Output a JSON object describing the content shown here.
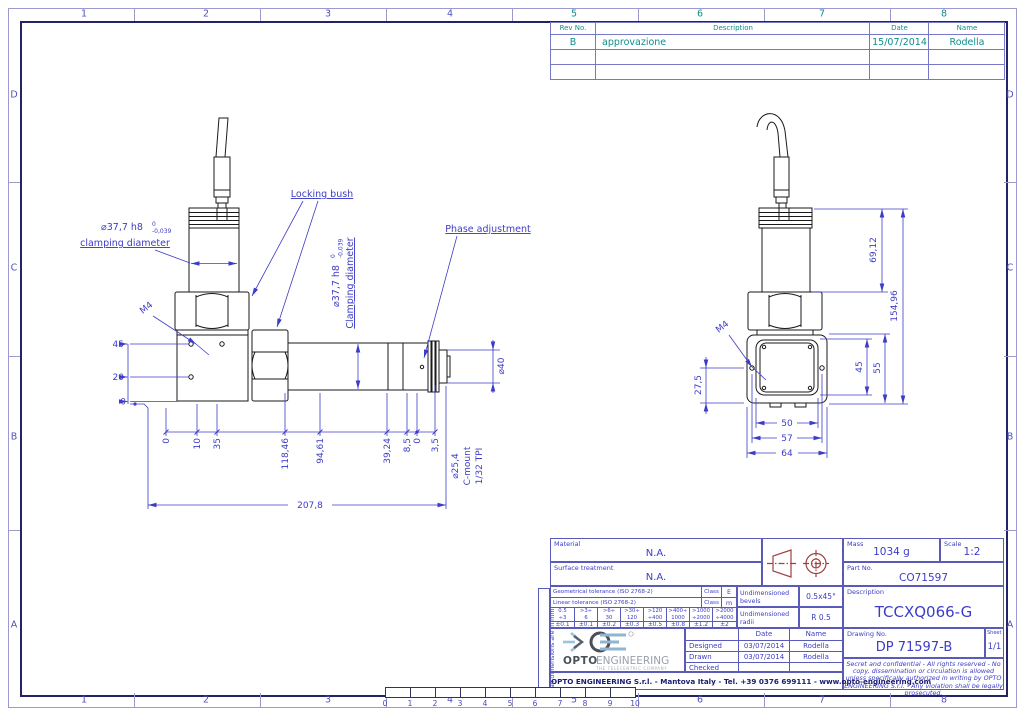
{
  "frame": {
    "zones_top": [
      "1",
      "2",
      "3",
      "4",
      "5",
      "6",
      "7",
      "8"
    ],
    "zones_bottom": [
      "1",
      "2",
      "3",
      "4",
      "5",
      "6",
      "7",
      "8"
    ],
    "zones_left": [
      "D",
      "C",
      "B",
      "A"
    ],
    "zones_right": [
      "D",
      "C",
      "B",
      "A"
    ],
    "ruler_ticks": [
      "0",
      "1",
      "2",
      "3",
      "4",
      "5",
      "6",
      "7",
      "8",
      "9",
      "10"
    ]
  },
  "revision_table": {
    "headers": {
      "rev": "Rev No.",
      "description": "Description",
      "date": "Date",
      "name": "Name"
    },
    "rows": [
      {
        "rev": "B",
        "description": "approvazione",
        "date": "15/07/2014",
        "name": "Rodella"
      }
    ]
  },
  "views": {
    "labels": {
      "locking_bush": "Locking bush",
      "phase_adjustment": "Phase adjustment",
      "clamp_left_value": "⌀37,7 h8",
      "clamp_left_tol_upper": "0",
      "clamp_left_tol_lower": "-0,039",
      "clamp_left_caption": "clamping diameter",
      "clamp_tube_value": "⌀37,7 h8",
      "clamp_tube_tol_upper": "0",
      "clamp_tube_tol_lower": "-0,039",
      "clamp_tube_caption": "Clamping diameter",
      "m4_left": "M4",
      "m4_right": "M4",
      "cmount_line1": "⌀25,4",
      "cmount_line2": "C-mount",
      "cmount_line3": "1/32 TPI",
      "dia40": "⌀40"
    },
    "left_dims": {
      "v45": "45",
      "v20": "20",
      "v0": "0",
      "chain": [
        "0",
        "10",
        "35",
        "118,46",
        "94,61",
        "39,24",
        "8,5",
        "0",
        "3,5"
      ],
      "overall": "207,8"
    },
    "right_dims": {
      "h69": "69,12",
      "h154": "154,96",
      "v45": "45",
      "v55": "55",
      "v27": "27,5",
      "w50": "50",
      "w57": "57",
      "w64": "64"
    }
  },
  "title_block": {
    "material_label": "Material",
    "material_value": "N.A.",
    "surface_label": "Surface treatment",
    "surface_value": "N.A.",
    "mass_label": "Mass",
    "mass_value": "1034 g",
    "scale_label": "Scale",
    "scale_value": "1:2",
    "part_no_label": "Part No.",
    "part_no_value": "CO71597",
    "description_label": "Description",
    "description_value": "TCCXQ066-G",
    "bevels_label": "Undimensioned bevels",
    "bevels_value": "0.5x45°",
    "radii_label": "Undimensioned radii",
    "radii_value": "R 0.5",
    "drawing_no_label": "Drawing No.",
    "drawing_no_value": "DP 71597-B",
    "sheet_label": "Sheet",
    "sheet_value": "1/1",
    "units_note": "all dimensions are in mm",
    "signatures": {
      "date_header": "Date",
      "name_header": "Name",
      "rows": [
        {
          "role": "Designed",
          "date": "03/07/2014",
          "name": "Rodella"
        },
        {
          "role": "Drawn",
          "date": "03/07/2014",
          "name": "Rodella"
        },
        {
          "role": "Checked",
          "date": "",
          "name": ""
        }
      ]
    },
    "tolerance": {
      "geo_label": "Geometrical tolerance (ISO 2768-2)",
      "lin_label": "Linear tolerance (ISO 2768-2)",
      "class_label": "Class",
      "geo_class": "E",
      "lin_class": "m",
      "ranges": [
        {
          "top": "0.5",
          "bottom": "÷3"
        },
        {
          "top": ">3÷",
          "bottom": "6"
        },
        {
          "top": ">6÷",
          "bottom": "30"
        },
        {
          "top": ">30÷",
          "bottom": "120"
        },
        {
          "top": ">120",
          "bottom": "÷400"
        },
        {
          "top": ">400÷",
          "bottom": "1000"
        },
        {
          "top": ">1000",
          "bottom": "÷2000"
        },
        {
          "top": ">2000",
          "bottom": "÷4000"
        }
      ],
      "values": [
        "±0.1",
        "±0.1",
        "±0.2",
        "±0.3",
        "±0.5",
        "±0.8",
        "±1.2",
        "±2"
      ]
    },
    "confidential": "Secret and confidential - All rights reserved - No copy, dissemination or circulation is allowed unless specifically authorized in writing by OPTO ENGINEERING S.r.l. - Any violation shall be legally prosecuted.",
    "company_line": "OPTO ENGINEERING S.r.l.  -  Mantova Italy -  Tel. +39 0376 699111  -  www.opto-engineering.com",
    "logo": {
      "brand_bold": "OPTO",
      "brand_light": "ENGINEERING",
      "tagline": "THE TELECENTRIC COMPANY"
    }
  }
}
